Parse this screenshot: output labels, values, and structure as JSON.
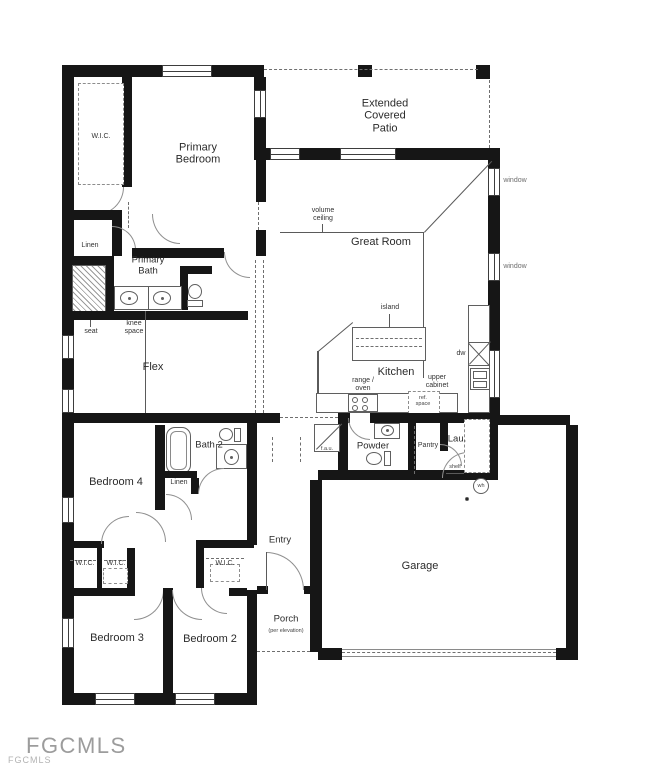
{
  "watermark": {
    "primary": "FGCMLS",
    "secondary": "FGCMLS"
  },
  "rooms": {
    "wic_primary": "W.I.C.",
    "primary_bedroom": "Primary\nBedroom",
    "linen_primary": "Linen",
    "primary_bath": "Primary\nBath",
    "extended_patio": "Extended\nCovered\nPatio",
    "great_room": "Great Room",
    "flex": "Flex",
    "kitchen": "Kitchen",
    "bath2": "Bath 2",
    "bedroom4": "Bedroom 4",
    "linen_hall": "Linen",
    "powder": "Powder",
    "pantry": "Pantry",
    "laundry": "Lau.",
    "entry": "Entry",
    "garage": "Garage",
    "wic_bedroom3_a": "W.I.C.",
    "wic_bedroom3_b": "W.I.C.",
    "wic_bedroom2": "W.I.C.",
    "bedroom3": "Bedroom 3",
    "bedroom2": "Bedroom 2",
    "porch": "Porch",
    "porch_note": "(per elevation)"
  },
  "annotations": {
    "volume_ceiling": "volume\nceiling",
    "island": "island",
    "window_upper": "window",
    "window_lower": "window",
    "seat": "seat",
    "knee_space": "knee\nspace",
    "range_oven": "range /\noven",
    "upper_cabinet": "upper\ncabinet",
    "ref_space": "ref.\nspace",
    "dishwasher": "dw",
    "fau": "f.a.u.",
    "shelf": "shelf",
    "water_heater": "wh"
  }
}
